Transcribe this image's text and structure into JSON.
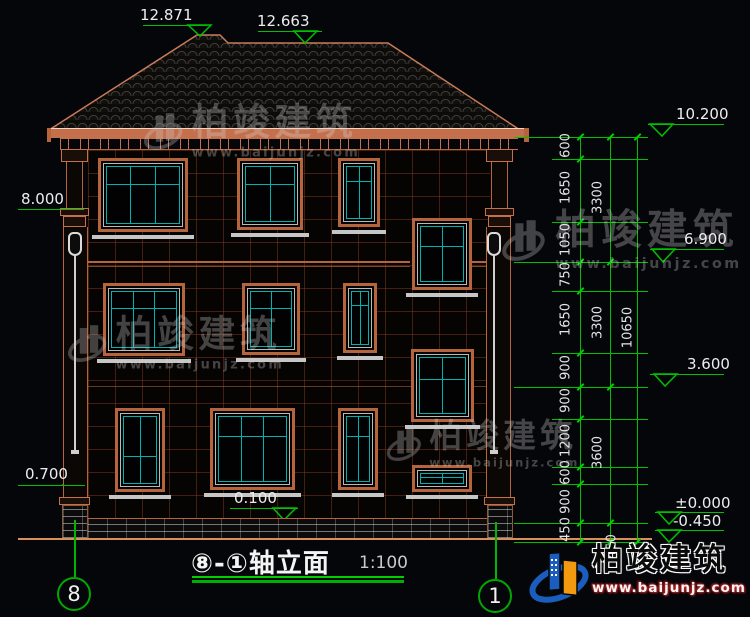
{
  "drawing": {
    "title": "⑧-①轴立面",
    "scale": "1:100",
    "axis_left": "8",
    "axis_right": "1"
  },
  "levels": {
    "ridge_main": "12.871",
    "ridge_secondary": "12.663",
    "eave": "10.200",
    "left_upper": "8.000",
    "floor3": "6.900",
    "floor2": "3.600",
    "left_lower": "0.700",
    "plinth": "0.100",
    "zero": "±0.000",
    "foundation": "-0.450"
  },
  "dimensions": {
    "col1": [
      "600",
      "1650",
      "1050",
      "750",
      "1650",
      "900",
      "900",
      "1200",
      "600",
      "900",
      "450"
    ],
    "col2": [
      "3300",
      "3300",
      "3600",
      "450"
    ],
    "col3": [
      "10650"
    ]
  },
  "watermark": {
    "brand": "柏竣建筑",
    "site": "www.baijunjz.com"
  },
  "logo": {
    "brand": "柏竣建筑",
    "site": "www.baijunjz.com"
  }
}
